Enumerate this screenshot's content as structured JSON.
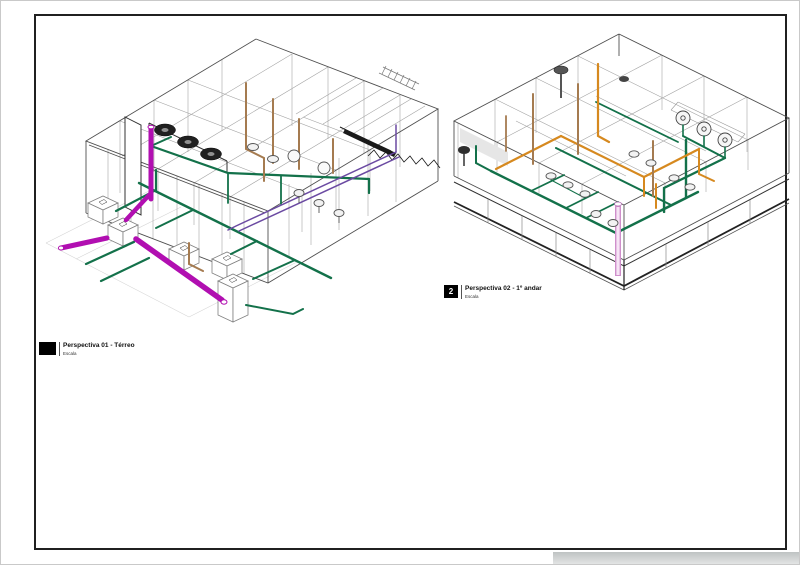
{
  "sheet": {
    "background_color": "#ffffff",
    "frame_color": "#202020"
  },
  "viewports": [
    {
      "number": "",
      "title": "Perspectiva 01 - Térreo",
      "scale_label": "Escala"
    },
    {
      "number": "2",
      "title": "Perspectiva 02 - 1º andar",
      "scale_label": "Escala"
    }
  ],
  "colors": {
    "wireframe_light": "#a3a3a3",
    "wireframe_dark": "#4f4f4f",
    "ground_line": "#d6d6d6",
    "pipe_sewage_magenta": "#b10fb1",
    "pipe_water_green": "#13714a",
    "pipe_drain_brown": "#a57b50",
    "pipe_vent_purple": "#6b4aa2",
    "pipe_hot_orange": "#d6891f",
    "pipe_rain_pink": "#cf8fcb",
    "fixture_stroke": "#555555",
    "stair_black": "#1a1a1a"
  }
}
